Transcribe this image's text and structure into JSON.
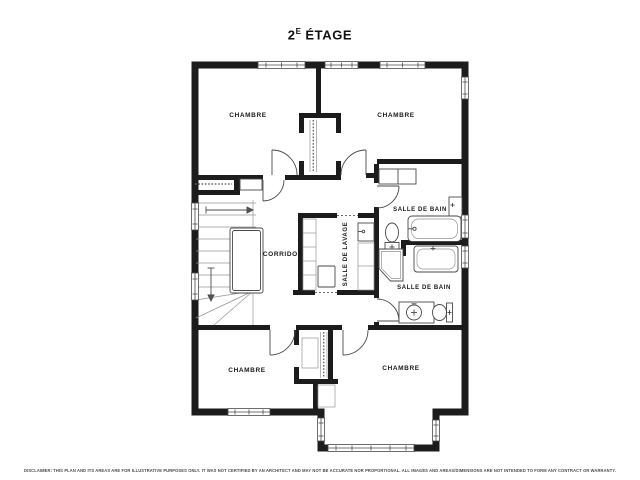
{
  "title": {
    "number": "2",
    "superscript": "E",
    "rest": " ÉTAGE"
  },
  "rooms": {
    "bedroom_top_left": "CHAMBRE",
    "bedroom_top_right": "CHAMBRE",
    "bedroom_bottom_left": "CHAMBRE",
    "bedroom_bottom_right": "CHAMBRE",
    "bathroom_top": "SALLE DE BAIN",
    "bathroom_bottom": "SALLE DE BAIN",
    "laundry": "SALLE DE LAVAGE",
    "corridor": "CORRIDOR"
  },
  "disclaimer": "DISCLAIMER: THIS PLAN AND ITS AREAS ARE FOR ILLUSTRATIVE PURPOSES ONLY. IT WAS NOT CERTIFIED BY AN ARCHITECT AND MAY NOT BE ACCURATE NOR PROPORTIONAL. ALL IMAGES AND AREAS/DIMENSIONS ARE NOT INTENDED TO FORM ANY CONTRACT OR WARRANTY.",
  "colors": {
    "wall": "#1c1c1c",
    "fixture": "#4a4a4a",
    "light": "#949494",
    "background": "#ffffff"
  }
}
